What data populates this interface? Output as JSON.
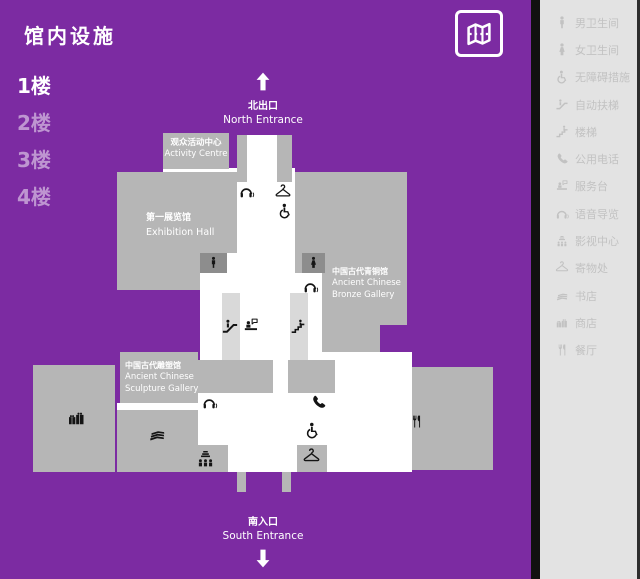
{
  "title": "馆内设施",
  "floors": [
    {
      "label": "1楼",
      "active": true
    },
    {
      "label": "2楼",
      "active": false
    },
    {
      "label": "3楼",
      "active": false
    },
    {
      "label": "4楼",
      "active": false
    }
  ],
  "plan": {
    "north": {
      "cn": "北出口",
      "en": "North Entrance"
    },
    "south": {
      "cn": "南入口",
      "en": "South Entrance"
    },
    "blocks": {
      "activity": {
        "cn": "观众活动中心",
        "en": "Activity Centre"
      },
      "exhibition": {
        "cn": "第一展览馆",
        "en": "Exhibition Hall"
      },
      "bronze": {
        "cn": "中国古代青铜馆",
        "en1": "Ancient Chinese",
        "en2": "Bronze Gallery"
      },
      "sculpture": {
        "cn": "中国古代雕塑馆",
        "en1": "Ancient Chinese",
        "en2": "Sculpture Gallery"
      }
    },
    "markers": [
      "audio-guide",
      "cloakroom",
      "wheelchair",
      "male-toilet",
      "female-toilet",
      "escalator",
      "service-desk",
      "stairs",
      "public-phone",
      "bookstore",
      "shop",
      "cinema",
      "restaurant"
    ]
  },
  "map_button": {
    "icon": "map-icon"
  },
  "sidebar": {
    "items": [
      {
        "icon": "male-icon",
        "label": "男卫生间"
      },
      {
        "icon": "female-icon",
        "label": "女卫生间"
      },
      {
        "icon": "wheelchair-icon",
        "label": "无障碍措施"
      },
      {
        "icon": "escalator-icon",
        "label": "自动扶梯"
      },
      {
        "icon": "stairs-icon",
        "label": "楼梯"
      },
      {
        "icon": "phone-icon",
        "label": "公用电话"
      },
      {
        "icon": "service-desk-icon",
        "label": "服务台"
      },
      {
        "icon": "audio-guide-icon",
        "label": "语音导览"
      },
      {
        "icon": "cinema-icon",
        "label": "影视中心"
      },
      {
        "icon": "hanger-icon",
        "label": "寄物处"
      },
      {
        "icon": "books-icon",
        "label": "书店"
      },
      {
        "icon": "gift-icon",
        "label": "商店"
      },
      {
        "icon": "restaurant-icon",
        "label": "餐厅"
      }
    ]
  },
  "colors": {
    "purple": "#7C2BA2",
    "block_gray": "#B6B6B6",
    "strip_gray": "#D9D9D9",
    "dark_gray": "#8D8D8D",
    "sidebar_bg": "#E3E3E3",
    "sidebar_text": "#C2C2C2",
    "icon_black": "#141414",
    "white": "#FFFFFF"
  }
}
